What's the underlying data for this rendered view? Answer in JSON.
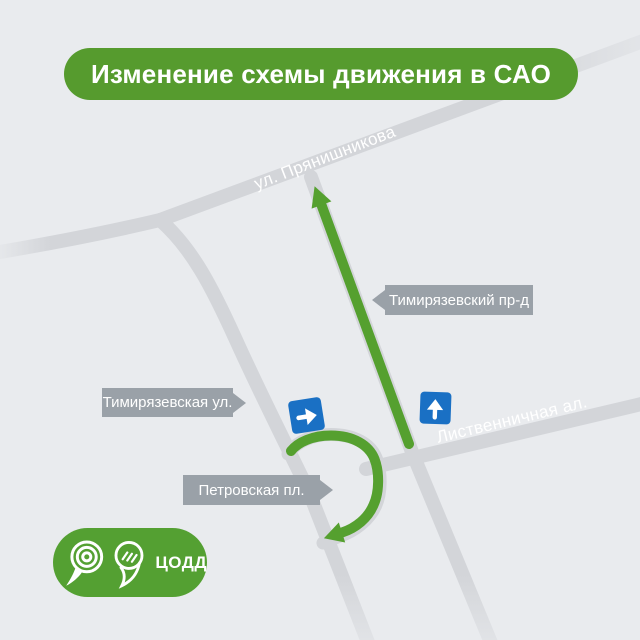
{
  "header": {
    "title": "Изменение схемы движения в САО"
  },
  "map": {
    "streets": [
      {
        "id": "pryanishnikova",
        "label": "ул. Прянишникова"
      },
      {
        "id": "listvennichnaya",
        "label": "Лиственничная ал."
      }
    ],
    "callouts": [
      {
        "id": "timiryazevsky-proezd",
        "label": "Тимирязевский пр-д",
        "pointer": "left"
      },
      {
        "id": "timiryazevskaya-ul",
        "label": "Тимирязевская ул.",
        "pointer": "right"
      },
      {
        "id": "petrovskaya-pl",
        "label": "Петровская пл.",
        "pointer": "right"
      }
    ],
    "signs": [
      {
        "id": "one-way-right",
        "type": "one-way traffic sign, arrow right"
      },
      {
        "id": "one-way-up",
        "type": "one-way traffic sign, arrow up"
      }
    ],
    "routes": [
      {
        "id": "route-timiryazevsky-proezd",
        "shape": "straight arrow up along Тимирязевский пр-д"
      },
      {
        "id": "route-petrovskaya-uturn",
        "shape": "U-turn loop arrow around Петровская пл."
      }
    ]
  },
  "logo": {
    "org": "ЦОДД"
  },
  "colors": {
    "background": "#e9ebee",
    "road_gray": "#d3d5d9",
    "header_green": "#569b2e",
    "route_green": "#55a02f",
    "logo_green": "#54a032",
    "label_gray": "#9aa1a8",
    "sign_blue": "#1a70c4",
    "text_white": "#ffffff"
  }
}
